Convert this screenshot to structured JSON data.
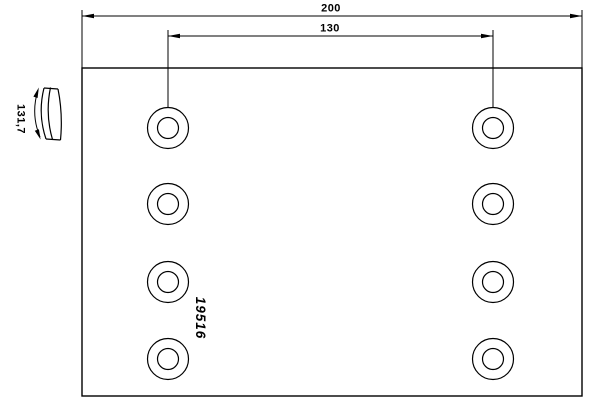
{
  "drawing": {
    "title": "brake-lining-technical-drawing",
    "part_number": "19516",
    "dimensions": {
      "overall_width_label": "200",
      "hole_spacing_label": "130",
      "arc_length_label": "131,7"
    },
    "holes": {
      "count": 8,
      "rows": 4,
      "columns": 2
    },
    "colors": {
      "line": "#000000",
      "background": "#ffffff"
    }
  }
}
